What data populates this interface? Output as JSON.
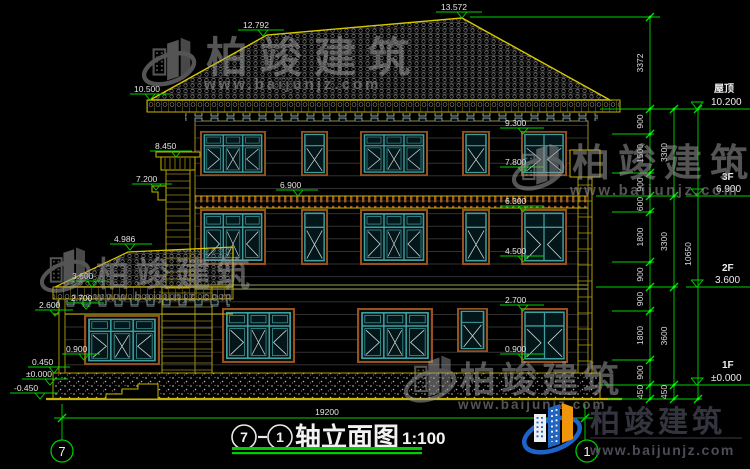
{
  "drawing": {
    "axis_start": "7",
    "axis_end": "1",
    "title": "轴立面图",
    "separator": "—",
    "scale": "1:100",
    "overall_width": "19200"
  },
  "levels_left": {
    "apex": "13.572",
    "roof_break": "12.792",
    "eave": "10.500",
    "column_cap": "8.450",
    "corbel": "7.200",
    "floor3": "6.900",
    "win3_head": "9.300",
    "win3_sill": "7.800",
    "win2_head": "6.300",
    "win2_sill": "4.500",
    "porch_ridge": "4.986",
    "porch_eave": "3.600",
    "porch_beam": "2.600",
    "porch_win_head": "2.700",
    "porch_win_sill": "0.900",
    "win1_head": "2.700",
    "win1_sill": "0.900",
    "plinth_top": "0.450",
    "floor1": "±0.000",
    "ground": "-0.450"
  },
  "levels_right": {
    "roof_name": "屋顶",
    "roof_level": "10.200",
    "f3_name": "3F",
    "f3_level": "6.900",
    "f2_name": "2F",
    "f2_level": "3.600",
    "f1_name": "1F",
    "f1_level": "±0.000"
  },
  "dims": {
    "inner": [
      "3372",
      "900",
      "1500",
      "900",
      "600",
      "1800",
      "900",
      "900",
      "1800",
      "900",
      "450"
    ],
    "mid": [
      "3300",
      "3300",
      "3600",
      "450"
    ],
    "outer": [
      "10650"
    ]
  },
  "watermark": {
    "brand": "柏竣建筑",
    "url": "www.baijunjz.com"
  },
  "logo": {
    "brand": "柏竣建筑",
    "url": "www.baijunjz.com"
  },
  "colors": {
    "line_yellow": "#c8b400",
    "roof_yellow": "#d8c800",
    "dim_green": "#00d400",
    "text_white": "#e4e4e4",
    "frame_brown": "#96521e",
    "frame_teal": "#3f9e9e",
    "logo_blue": "#2165c0",
    "logo_orange": "#f0940c"
  }
}
